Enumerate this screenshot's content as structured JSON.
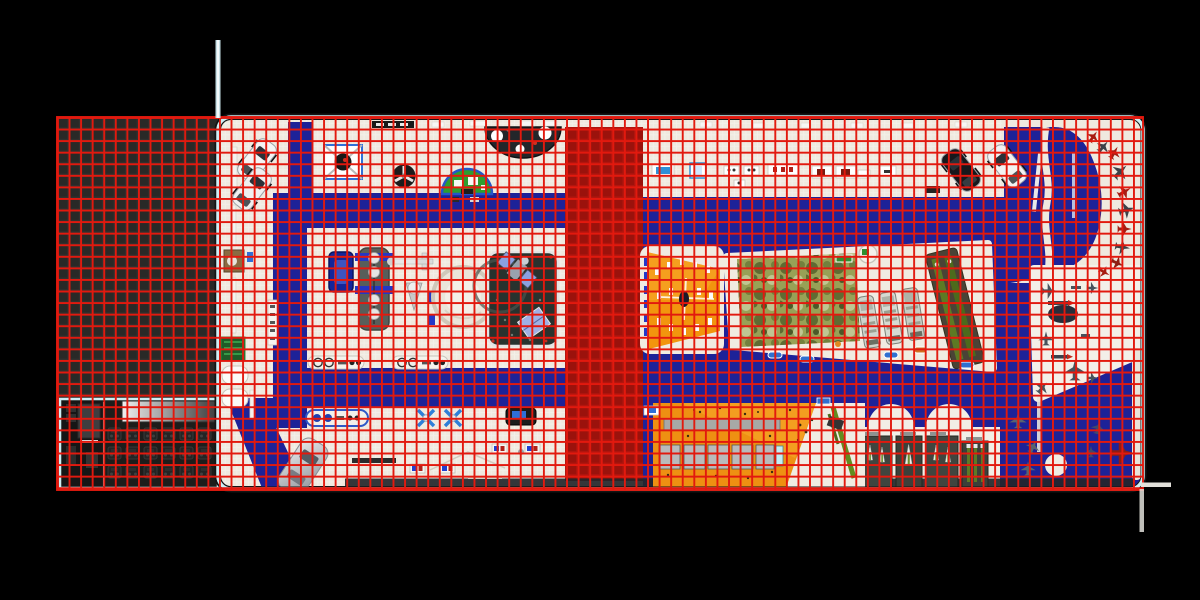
{
  "scene": {
    "name": "exhibition-hall-floor-plan-top-view",
    "grid_cell_px": 11.57
  },
  "colors": {
    "background": "#000000",
    "grid_red": "#e2190e",
    "apron": "#31312f",
    "floor": "#efe9df",
    "carpet_blue": "#1d2298",
    "carpet_red": "#b2150e",
    "outline": "#cdeef4",
    "booth_orange": "#f2950e",
    "diorama_orange": "#ee9012",
    "camo": "#98a156",
    "pole": "#c6dfe6",
    "marker": "#e2e0da"
  }
}
